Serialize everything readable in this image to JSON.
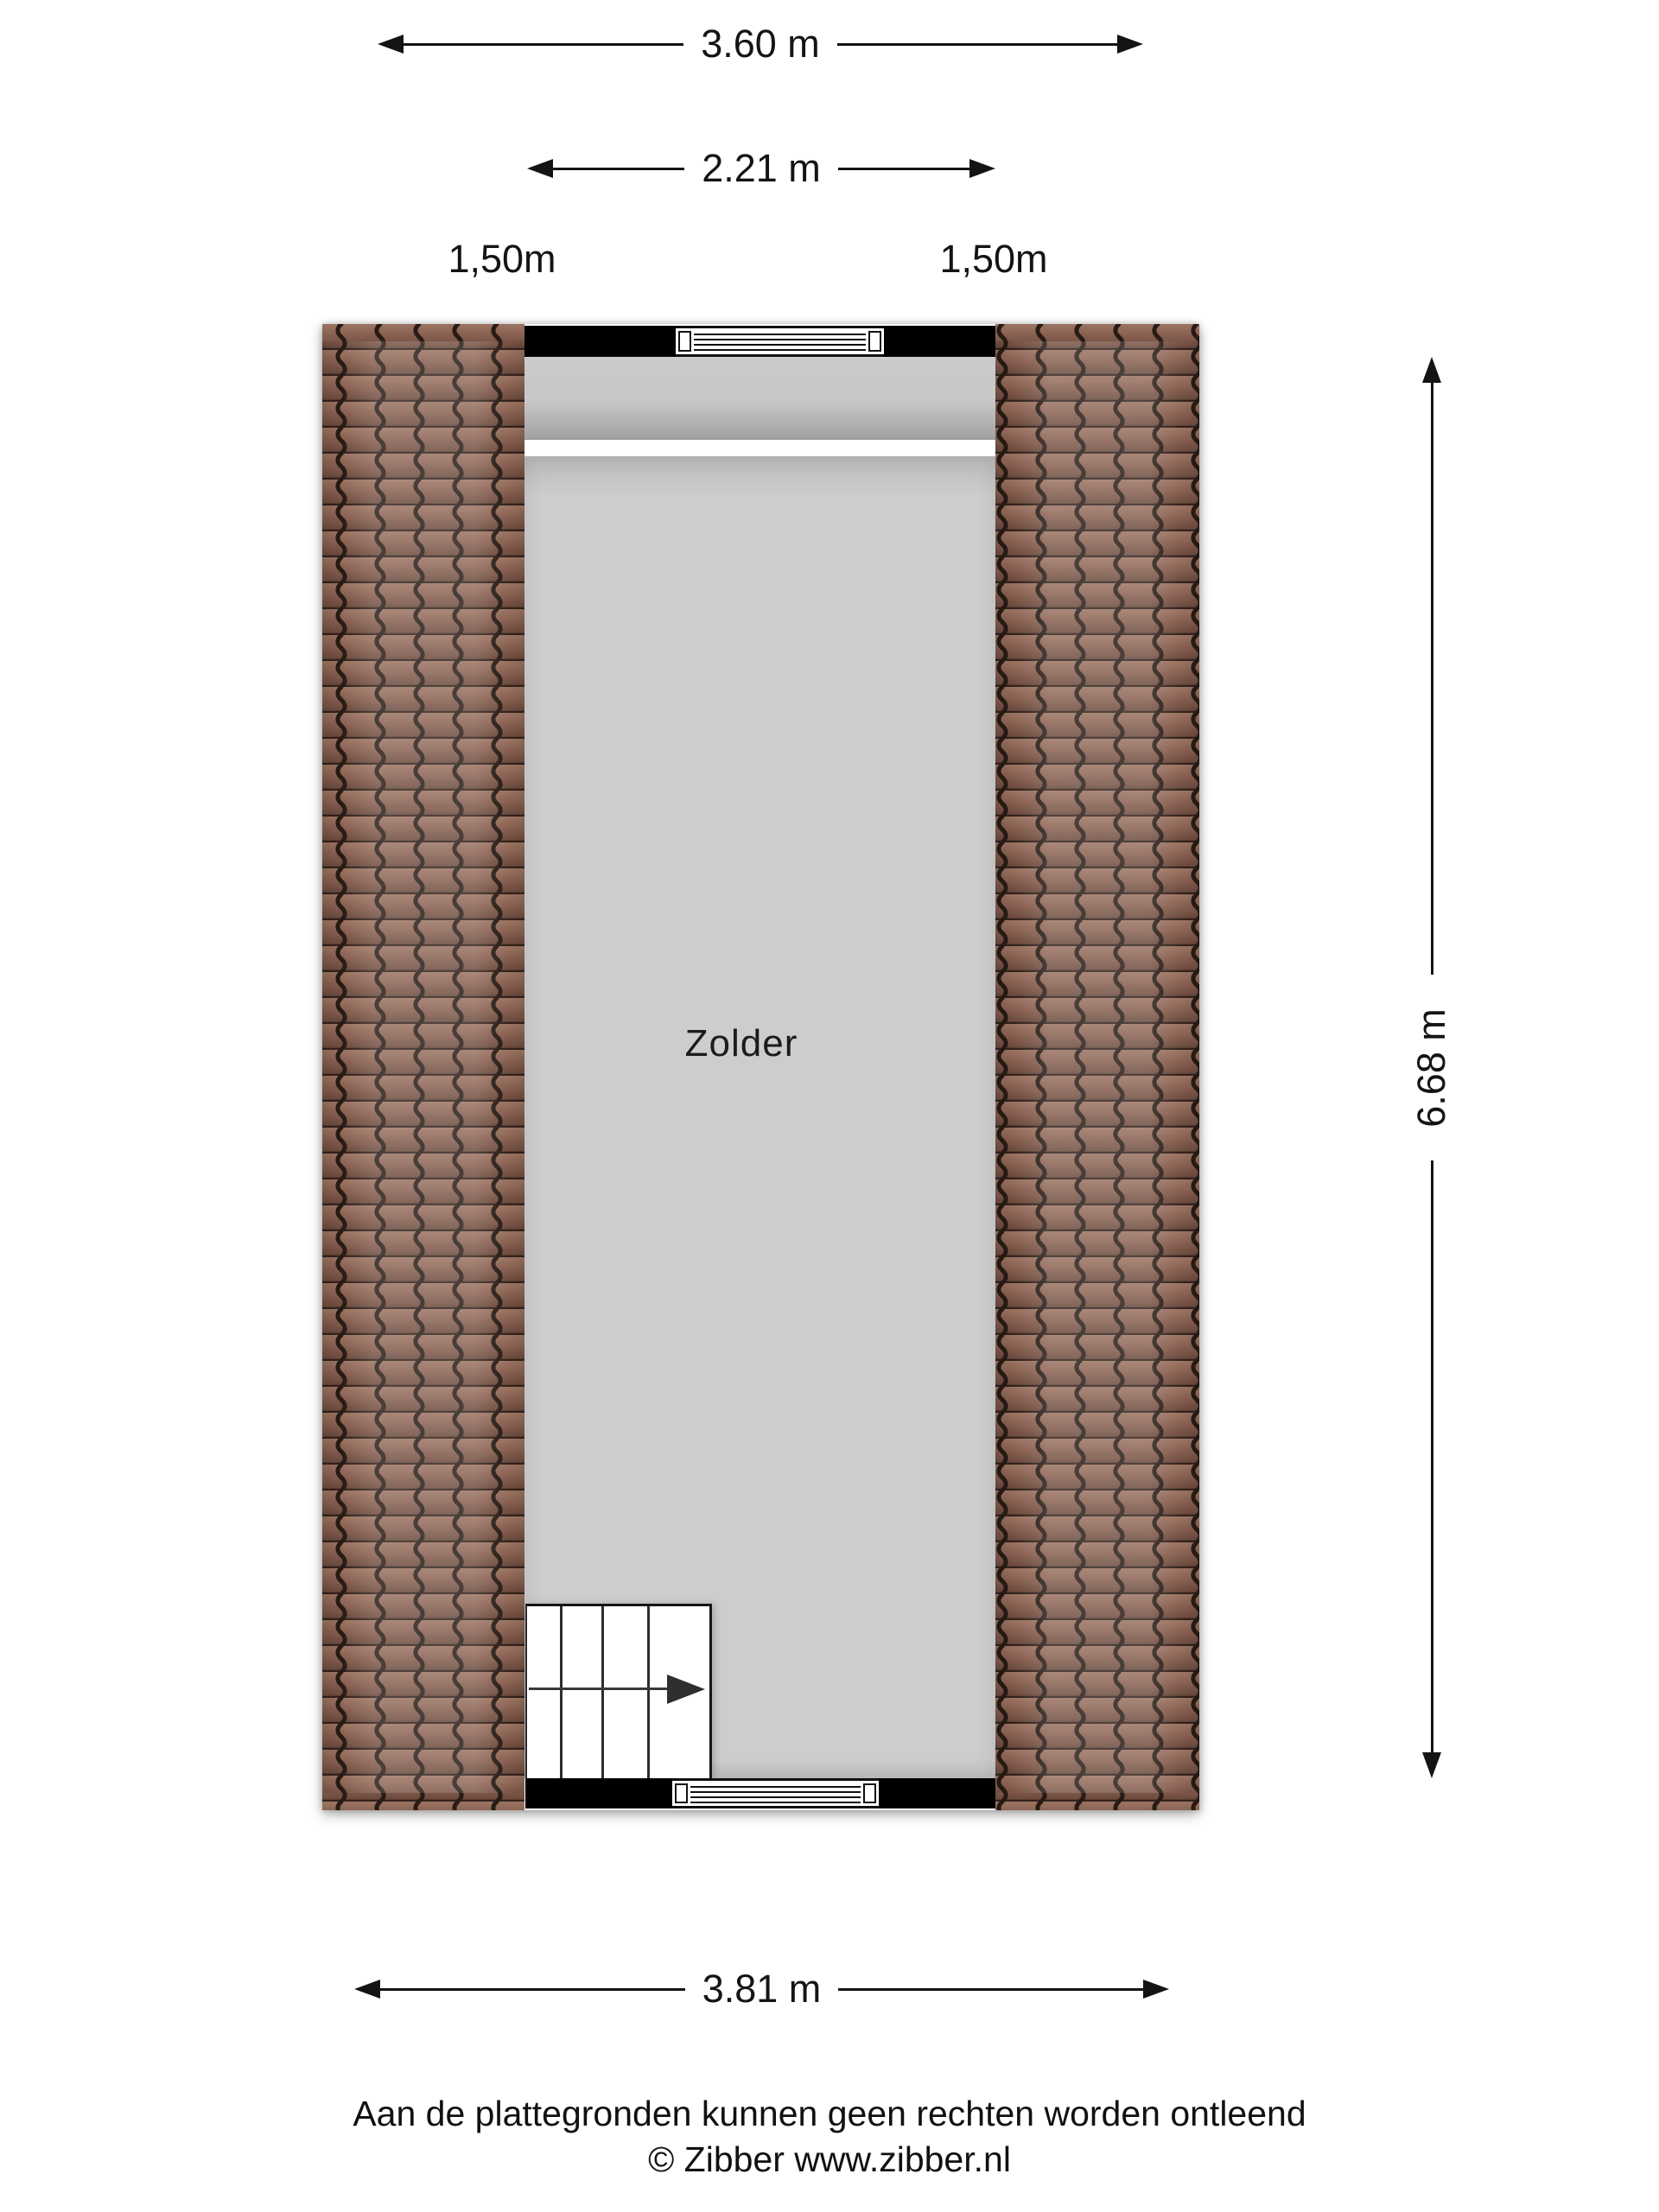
{
  "plan": {
    "room_label": "Zolder",
    "dim_total_width_top": "3.60 m",
    "dim_inner_width": "2.21 m",
    "dim_height_left": "1,50m",
    "dim_height_right": "1,50m",
    "dim_length_right": "6.68 m",
    "dim_total_width_bottom": "3.81 m"
  },
  "footer": {
    "disclaimer": "Aan de plattegronden kunnen geen rechten worden ontleend",
    "copyright": "© Zibber www.zibber.nl"
  },
  "colors": {
    "wall_black": "#000000",
    "roof_tile_brown": "#855d4e",
    "roof_tile_line": "#2a1d17",
    "floor_gray": "#cdcdcd",
    "dimension_line": "#141414",
    "background": "#ffffff"
  },
  "icons": {
    "dimension_arrowhead": "css-triangle",
    "stairs_direction_arrow": "css-triangle-with-line"
  }
}
